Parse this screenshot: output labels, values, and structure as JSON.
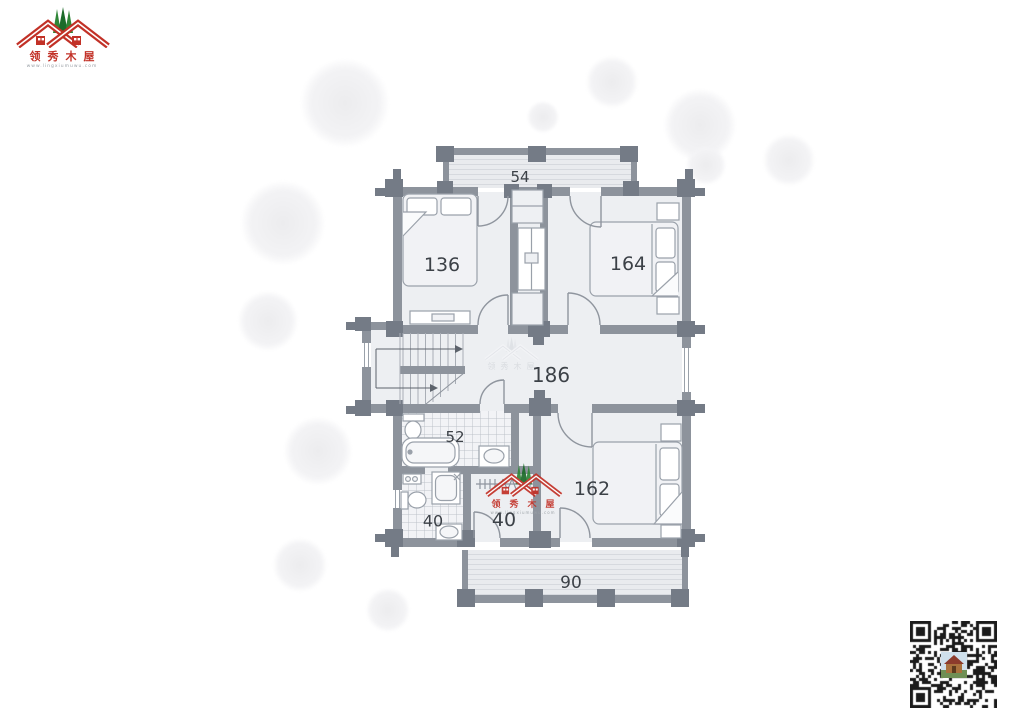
{
  "brand": {
    "name": "领秀木屋",
    "website": "www.lingxiumuwu.com"
  },
  "plan": {
    "labels": {
      "balcony_top": "54",
      "bedroom_top_left": "136",
      "bedroom_top_right": "164",
      "hallway": "186",
      "bathroom_large": "52",
      "bathroom_small": "40",
      "closet": "40",
      "bedroom_bottom": "162",
      "balcony_bottom": "90"
    }
  },
  "colors": {
    "wall": "#8d939c",
    "post": "#747b86",
    "floor": "#edeff2",
    "logo_red": "#c23127",
    "logo_green": "#2f8637",
    "label_text": "#3c4147"
  }
}
